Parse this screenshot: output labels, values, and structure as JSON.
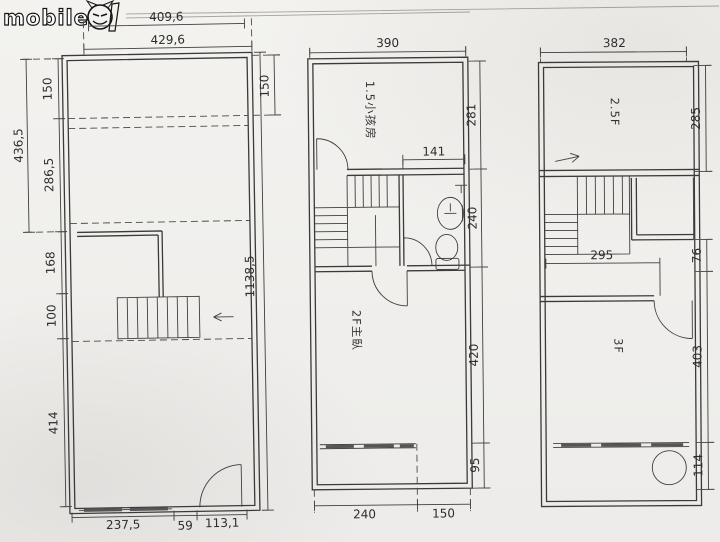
{
  "logo": {
    "brand": "mobile01",
    "word": "mobile"
  },
  "plan1": {
    "dims": {
      "top_inner": "409,6",
      "top_outer": "429,6",
      "left_total": "436,5",
      "left_a": "150",
      "left_b": "286,5",
      "left_c": "168",
      "left_d": "100",
      "left_e": "414",
      "right_a": "150",
      "right_total": "1138,5",
      "bottom_a": "237,5",
      "bottom_b": "59",
      "bottom_c": "113,1"
    }
  },
  "plan2": {
    "rooms": {
      "upper": "1.5小孩房",
      "lower": "2F主臥"
    },
    "dims": {
      "top": "390",
      "right_a": "281",
      "right_b": "240",
      "right_c": "420",
      "right_d": "95",
      "inner_width": "141",
      "bottom_a": "240",
      "bottom_b": "150"
    }
  },
  "plan3": {
    "rooms": {
      "upper": "2.5F",
      "lower": "3F"
    },
    "dims": {
      "top": "382",
      "right_a": "285",
      "right_b": "76",
      "right_c": "403",
      "right_d": "114",
      "inner_width": "295"
    }
  }
}
